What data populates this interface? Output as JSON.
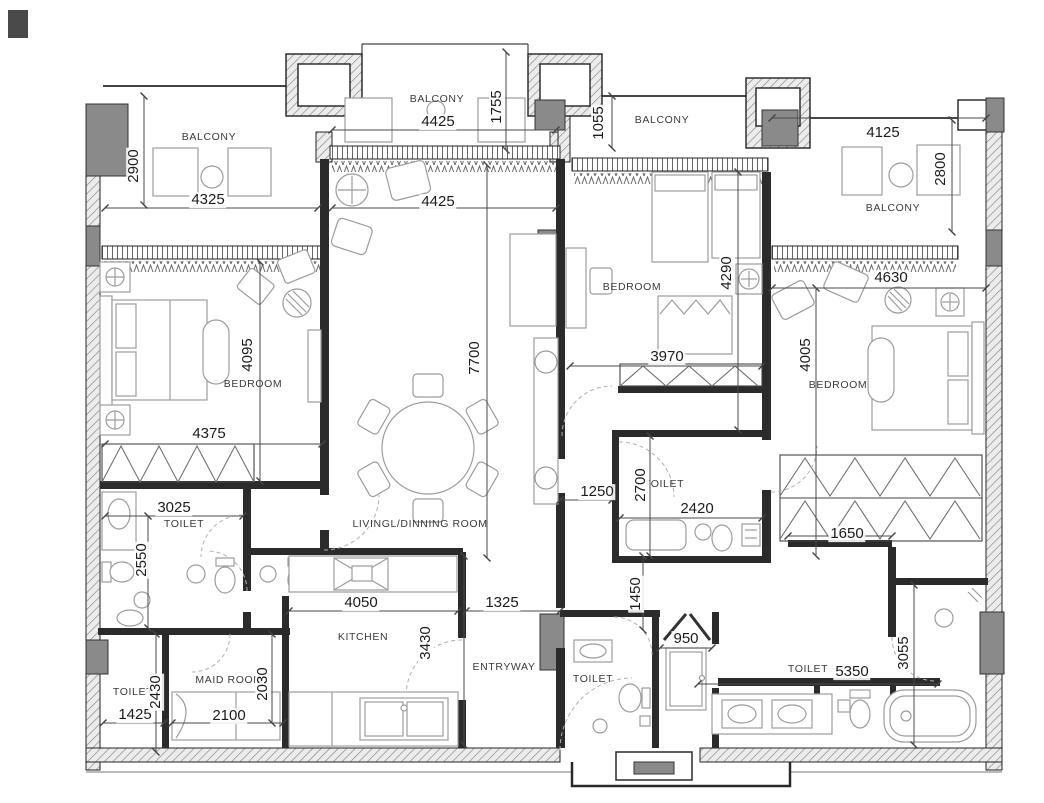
{
  "palette": {
    "wall": "#2b2b2b",
    "line_thin": "#555555",
    "furniture": "#9c9c9c",
    "column_fill": "#8a8a8a",
    "hatch_line": "#8c8c8c",
    "background": "#ffffff"
  },
  "rooms": {
    "balcony_top_left": "BALCONY",
    "balcony_top": "BALCONY",
    "balcony_mid": "BALCONY",
    "balcony_right": "BALCONY",
    "bedroom_left": "BEDROOM",
    "bedroom_center": "BEDROOM",
    "bedroom_right": "BEDROOM",
    "living_dining": "LIVINGL/DINNING ROOM",
    "kitchen": "KITCHEN",
    "entryway": "ENTRYWAY",
    "maid_room": "MAID ROOM",
    "toilet_left": "TOILET",
    "toilet_center": "TOILET",
    "toilet_bottom_left": "TOILET",
    "toilet_entry": "TOILET",
    "toilet_right": "TOILET"
  },
  "dims": {
    "balcony_left_width": "4325",
    "balcony_left_depth": "2900",
    "balcony_top_width": "4425",
    "balcony_top_depth": "1755",
    "balcony_mid_depth": "1055",
    "balcony_right_width": "4125",
    "balcony_right_depth": "2800",
    "living_width": "4425",
    "living_length": "7700",
    "bedroom_left_length": "4095",
    "bedroom_left_width": "4375",
    "bedroom_center_length": "4290",
    "bedroom_center_width": "3970",
    "bedroom_right_width": "4630",
    "bedroom_right_length": "4005",
    "toilet_left_width": "3025",
    "toilet_left_depth": "2550",
    "hall_center_width": "1250",
    "toilet_center_depth": "2700",
    "toilet_center_width": "2420",
    "hall_right_width": "1650",
    "kitchen_width": "4050",
    "kitchen_depth": "3430",
    "entry_width": "1325",
    "entry_depth": "1450",
    "niche_width": "950",
    "toilet_bl_width": "1425",
    "toilet_bl_depth": "2430",
    "maid_width": "2100",
    "maid_depth": "2030",
    "toilet_right_width": "5350",
    "toilet_right_depth": "3055"
  }
}
